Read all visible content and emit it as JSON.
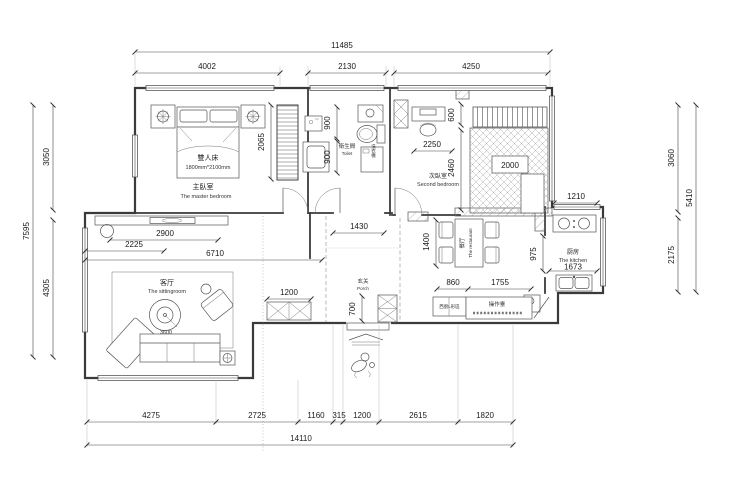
{
  "plan": {
    "dims": {
      "t_total": "11485",
      "t1": "4002",
      "t2": "2130",
      "t3": "4250",
      "l_total": "7595",
      "l1": "3050",
      "l2": "4305",
      "r_total": "5410",
      "r1": "3060",
      "r2": "2175",
      "b_total": "14110",
      "b1": "4275",
      "b2": "2725",
      "b3": "1160",
      "b4": "315",
      "b5": "1200",
      "b6": "2615",
      "b7": "1820",
      "wardrobe": "2065",
      "bath_a": "900",
      "bath_b": "900",
      "bed2_a": "600",
      "bed2_b": "2250",
      "bed2_c": "2460",
      "bed2_bed": "2000",
      "kit_a": "1210",
      "kit_b": "975",
      "kit_c": "1673",
      "din_a": "1400",
      "din_b": "860",
      "din_c": "1755",
      "hall": "1430",
      "porch": "700",
      "liv_a": "2225",
      "liv_b": "2900",
      "liv_c": "6710",
      "liv_d": "1200",
      "sofa": "3600"
    },
    "rooms": {
      "master": {
        "zh": "主臥室",
        "en": "The master bedroom"
      },
      "bed": {
        "zh": "雙人床",
        "size": "1800mm*2100mm"
      },
      "bath": {
        "zh": "衛生間",
        "en": "Toilet",
        "washer": "洗衣機"
      },
      "bed2": {
        "zh": "次臥室",
        "en": "Second bedroom"
      },
      "living": {
        "zh": "客厅",
        "en": "The sittingroom"
      },
      "porch": {
        "zh": "玄关",
        "en": "Porch"
      },
      "dining": {
        "zh": "餐厅",
        "en": "The restaurant"
      },
      "kitchen": {
        "zh": "厨房",
        "en": "The kitchen"
      },
      "counter": {
        "zh": "操作臺"
      },
      "cabinet": {
        "zh": "西廚L形區"
      }
    }
  }
}
